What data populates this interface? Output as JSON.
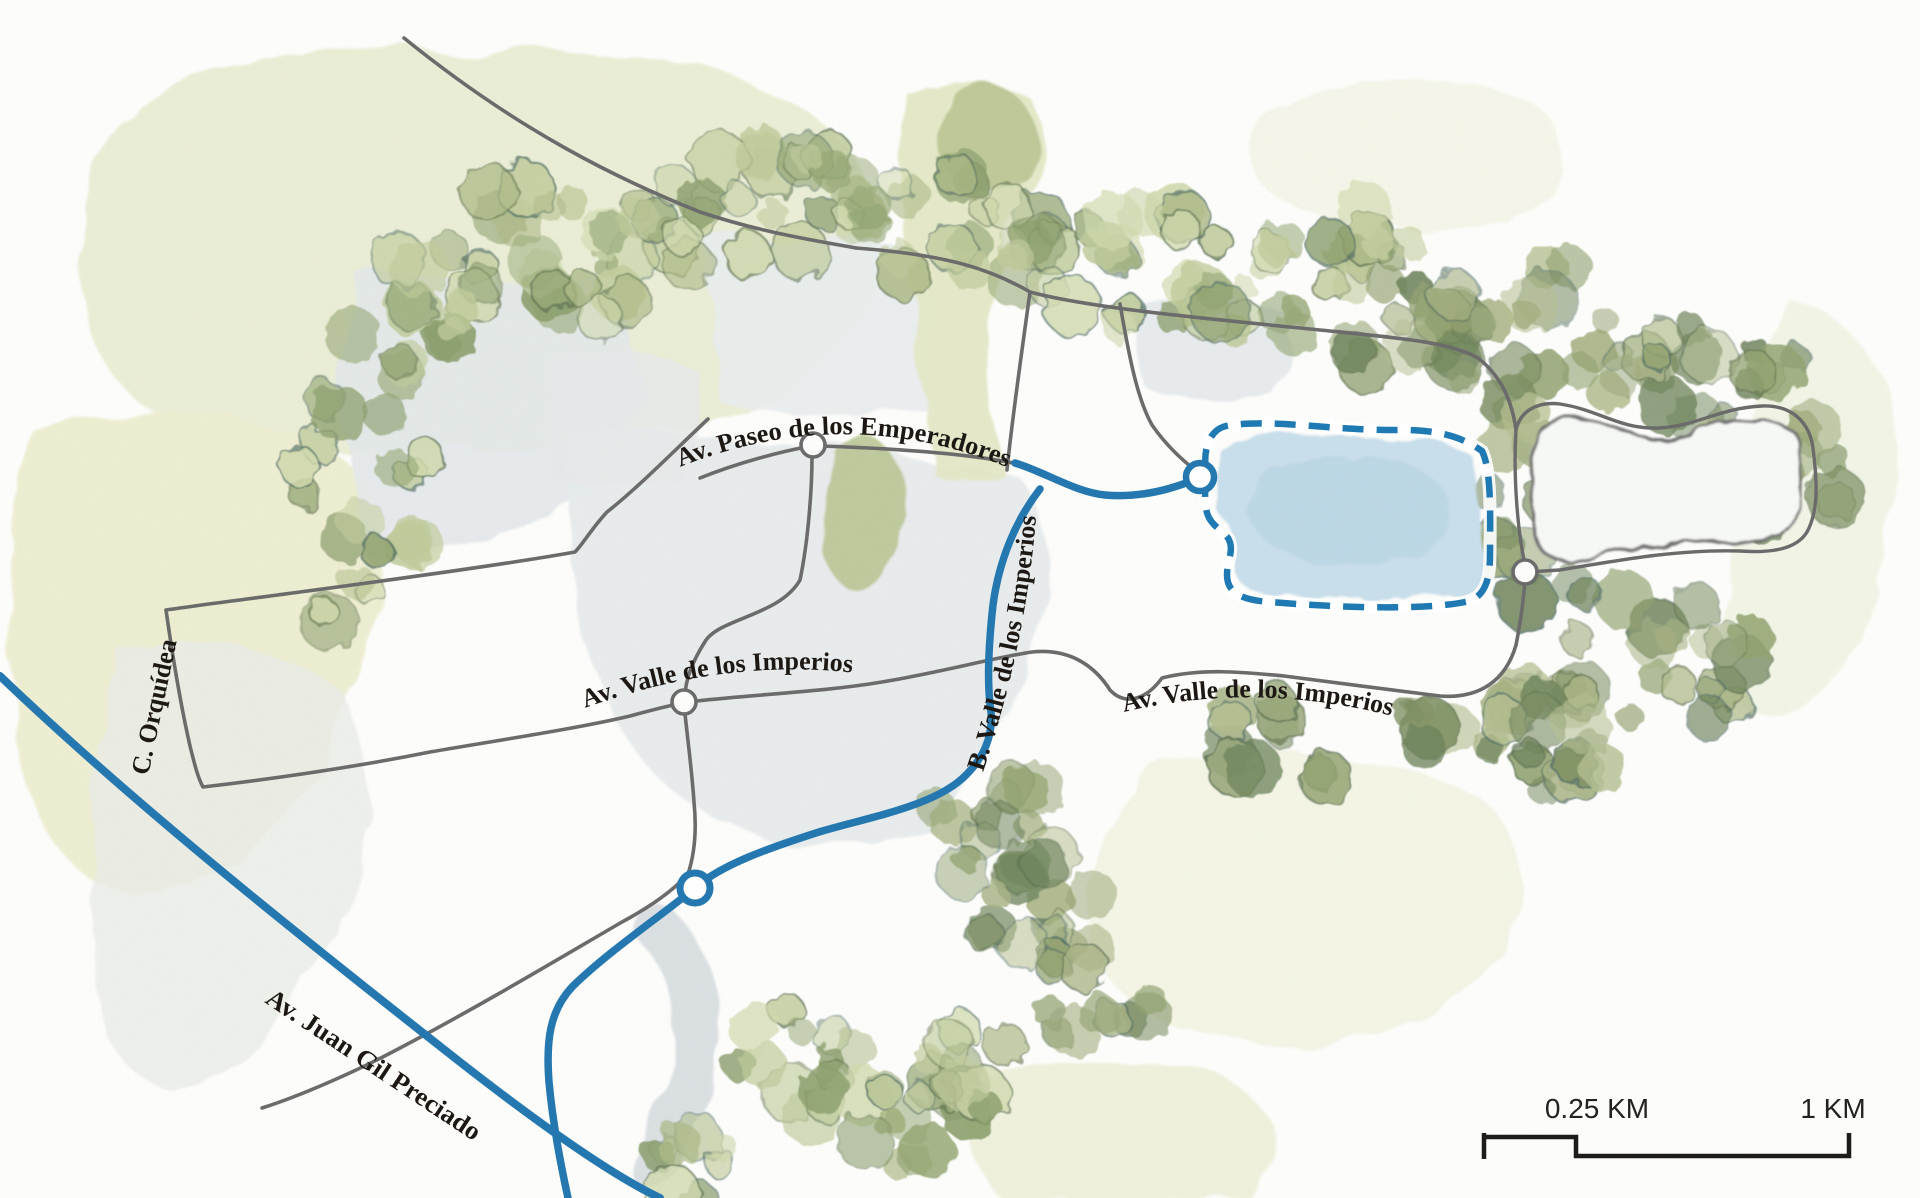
{
  "map": {
    "title": "watercolor park map",
    "labels": {
      "paseo": "Av. Paseo de los Emperadores",
      "orquidea": "C. Orquídea",
      "valle_left": "Av. Valle de los Imperios",
      "valle_b": "B. Valle de los Imperios",
      "valle_right": "Av. Valle de los Imperios",
      "juan_gil": "Av. Juan Gil Preciado"
    },
    "scale_bar": {
      "first_label": "0.25 KM",
      "second_label": "1 KM"
    },
    "highlighted_region": {
      "kind": "lake-area",
      "border_style": "dashed",
      "border_color": "#1e79b4",
      "fill_color": "#c9dfeb"
    },
    "colors": {
      "road_gray": "#6b6b6b",
      "road_blue": "#2478b0",
      "label_ink": "#1c1712",
      "wash_green": "#e9ecd2",
      "tree_olive": "#a8b385",
      "field_gray": "#e6eaec",
      "scale_ink": "#1d1b19"
    }
  }
}
